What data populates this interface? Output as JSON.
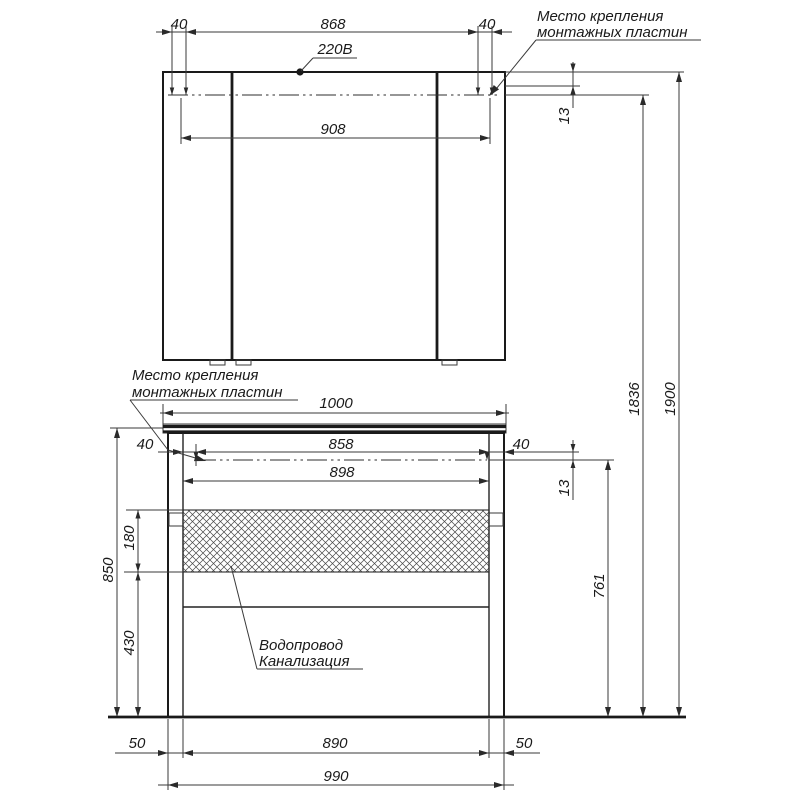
{
  "drawing": {
    "labels": {
      "mounting_line1": "Место крепления",
      "mounting_line2": "монтажных пластин",
      "power": "220В",
      "water": "Водопровод",
      "sewer": "Канализация"
    },
    "dimensions": {
      "mc_offset_left": "40",
      "mc_span": "868",
      "mc_offset_right": "40",
      "mc_width": "908",
      "mc_gap": "13",
      "mount_height": "1836",
      "total_height": "1900",
      "countertop_width": "1000",
      "v_offset_left": "40",
      "v_span": "858",
      "v_offset_right": "40",
      "v_inner": "898",
      "v_gap": "13",
      "v_mount_height": "761",
      "v_height": "850",
      "hatch_height": "180",
      "clearance_height": "430",
      "leg_left": "50",
      "leg_span": "890",
      "leg_right": "50",
      "v_width": "990"
    },
    "colors": {
      "line": "#2a2a2a",
      "background": "#ffffff"
    }
  }
}
